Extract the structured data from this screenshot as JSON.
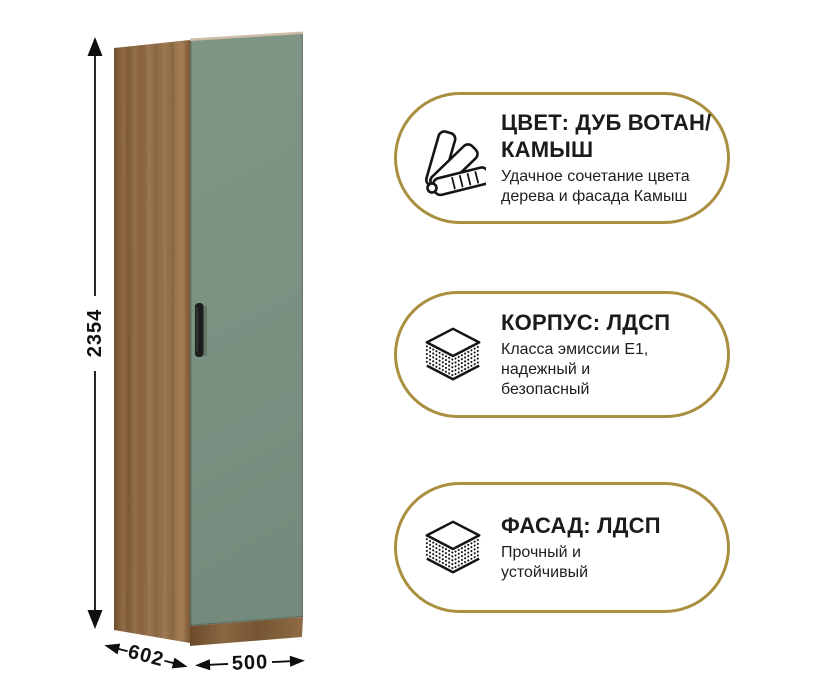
{
  "product": {
    "dimensions": {
      "height": "2354",
      "depth": "602",
      "width": "500"
    }
  },
  "badges": [
    {
      "icon": "color-swatches-icon",
      "title_lines": [
        "ЦВЕТ: ДУБ ВОТАН/",
        "КАМЫШ"
      ],
      "subtitle_lines": [
        "Удачное сочетание цвета",
        "дерева и фасада Камыш"
      ]
    },
    {
      "icon": "layers-icon",
      "title_lines": [
        "КОРПУС: ЛДСП"
      ],
      "subtitle_lines": [
        "Класса эмиссии Е1,",
        "надежный и",
        "безопасный"
      ]
    },
    {
      "icon": "layers-icon",
      "title_lines": [
        "ФАСАД: ЛДСП"
      ],
      "subtitle_lines": [
        "Прочный и",
        "устойчивый"
      ]
    }
  ],
  "colors": {
    "accent_gold": "#a98f3f",
    "wood_oak_votan": "#8a6742",
    "facade_green_kamysh": "#7b9081",
    "handle_black": "#1d1d1d",
    "text": "#1b1b1b"
  }
}
